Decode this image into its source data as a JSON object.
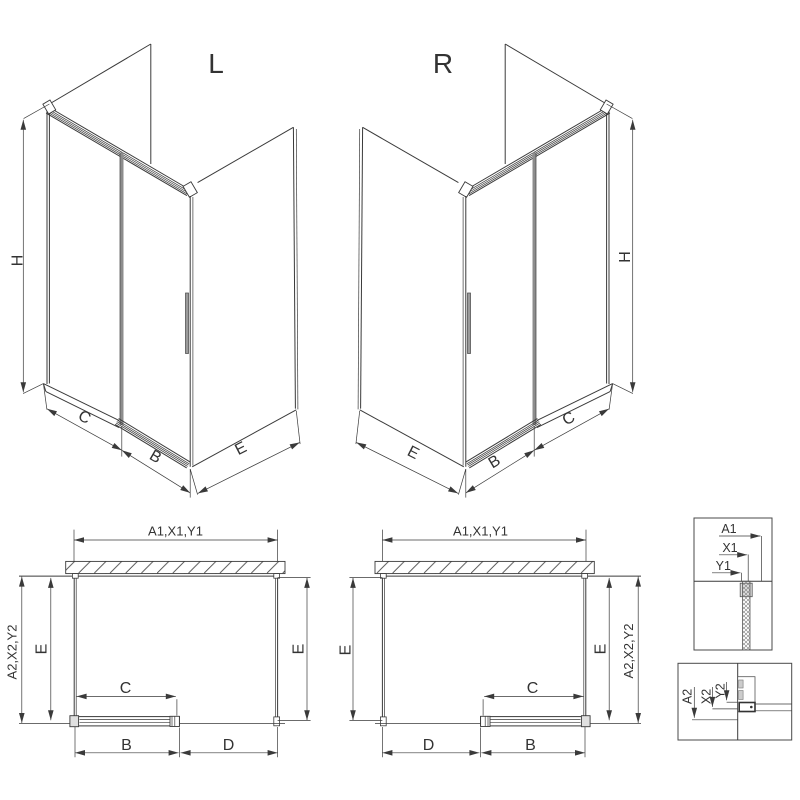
{
  "drawing_title": "shower-enclosure-3-sided-sliding-door-dimension-diagram",
  "iso_left": {
    "variant_label": "L",
    "dim_height": "H",
    "dim_front_fixed": "C",
    "dim_door": "B",
    "dim_side": "E"
  },
  "iso_right": {
    "variant_label": "R",
    "dim_height": "H",
    "dim_front_fixed": "C",
    "dim_door": "B",
    "dim_side": "E"
  },
  "plan_left": {
    "dim_width_top": "A1,X1,Y1",
    "dim_depth_outer": "A2,X2,Y2",
    "dim_depth_left": "E",
    "dim_depth_right": "E",
    "dim_door_travel": "C",
    "dim_door_panel": "B",
    "dim_opening": "D"
  },
  "plan_right": {
    "dim_width_top": "A1,X1,Y1",
    "dim_depth_outer": "A2,X2,Y2",
    "dim_depth_left": "E",
    "dim_depth_right": "E",
    "dim_door_travel": "C",
    "dim_door_panel": "B",
    "dim_opening": "D"
  },
  "detail_top": {
    "labels": [
      "A1",
      "X1",
      "Y1"
    ]
  },
  "detail_bottom": {
    "labels": [
      "A2",
      "X2",
      "Y2"
    ]
  },
  "colors": {
    "line": "#3a3a3a",
    "door_glass": "#8d8d8d",
    "block_fill": "#e0e0e0",
    "background": "#ffffff"
  }
}
